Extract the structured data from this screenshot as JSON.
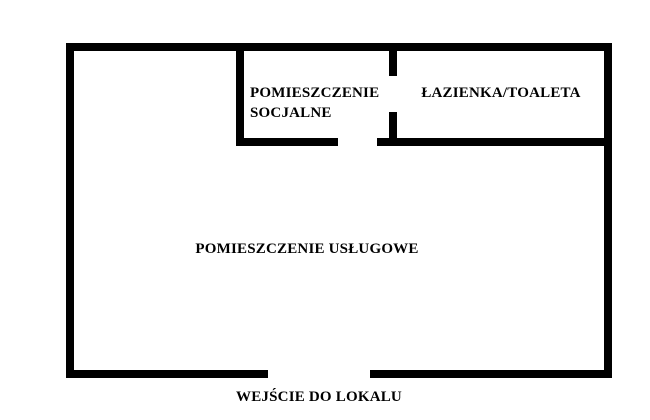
{
  "title": "Floor plan of premises",
  "colors": {
    "wall": "#000000",
    "background": "#ffffff",
    "text": "#000000"
  },
  "labels": {
    "social_room": "POMIESZCZENIE\nSOCJALNE",
    "bathroom": "ŁAZIENKA/TOALETA",
    "service_room": "POMIESZCZENIE USŁUGOWE",
    "entrance": "WEJŚCIE DO LOKALU"
  },
  "floor_plan": {
    "walls": [
      {
        "name": "wall-outer-top",
        "x": 66,
        "y": 43,
        "w": 546,
        "h": 8
      },
      {
        "name": "wall-outer-left",
        "x": 66,
        "y": 43,
        "w": 8,
        "h": 335
      },
      {
        "name": "wall-outer-right",
        "x": 604,
        "y": 43,
        "w": 8,
        "h": 335
      },
      {
        "name": "wall-outer-bottom-left",
        "x": 66,
        "y": 370,
        "w": 202,
        "h": 8
      },
      {
        "name": "wall-outer-bottom-right",
        "x": 370,
        "y": 370,
        "w": 242,
        "h": 8
      },
      {
        "name": "wall-social-left",
        "x": 236,
        "y": 43,
        "w": 8,
        "h": 103
      },
      {
        "name": "wall-social-bottom",
        "x": 236,
        "y": 138,
        "w": 102,
        "h": 8
      },
      {
        "name": "wall-bathroom-bottom",
        "x": 377,
        "y": 138,
        "w": 235,
        "h": 8
      },
      {
        "name": "wall-social-bathroom-upper",
        "x": 389,
        "y": 43,
        "w": 8,
        "h": 33
      },
      {
        "name": "wall-social-bathroom-lower",
        "x": 389,
        "y": 112,
        "w": 8,
        "h": 34
      }
    ],
    "openings": [
      {
        "name": "entrance-opening",
        "x": 268,
        "y": 370,
        "w": 102,
        "h": 8
      },
      {
        "name": "door-social-room",
        "x": 338,
        "y": 138,
        "w": 39,
        "h": 8
      },
      {
        "name": "door-bathroom",
        "x": 389,
        "y": 76,
        "w": 8,
        "h": 36
      }
    ]
  }
}
